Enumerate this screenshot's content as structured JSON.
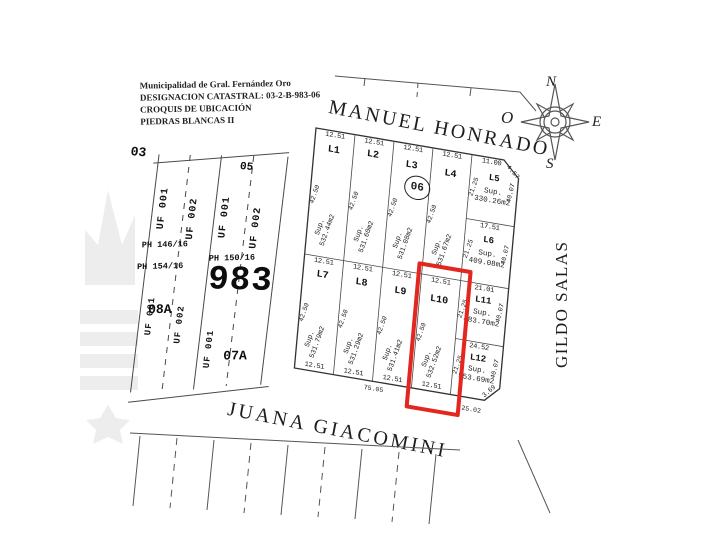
{
  "header": {
    "line1": "Municipalidad de Gral. Fernández Oro",
    "line2": "DESIGNACION CATASTRAL: 03-2-B-983-06",
    "line3": "CROQUIS DE UBICACIÓN",
    "line4": "PIEDRAS BLANCAS II"
  },
  "streets": {
    "top": "MANUEL HONRADO",
    "bottom": "JUANA GIACOMINI",
    "right": "GILDO SALAS"
  },
  "compass": {
    "n": "N",
    "e": "E",
    "s": "S",
    "w": "O"
  },
  "badge": "06",
  "left_block": {
    "corner": "03",
    "strip_a": {
      "uf1": "UF 001",
      "uf2": "UF 002",
      "ph1": "PH 146/16",
      "ph2": "PH 154/16",
      "uf3": "UF 001",
      "uf4": "UF 002",
      "label": "08A"
    },
    "strip_b": {
      "top": "05",
      "uf1": "UF 001",
      "uf2": "UF 002",
      "ph1": "PH 150/16",
      "big": "983",
      "uf3": "UF 001",
      "label": "07A"
    }
  },
  "lots": [
    {
      "id": "L1",
      "front": "12.51",
      "side": "42.50",
      "sup": "Sup.",
      "area": "532.44m2"
    },
    {
      "id": "L2",
      "front": "12.51",
      "side": "42.50",
      "sup": "Sup.",
      "area": "531.60m2"
    },
    {
      "id": "L3",
      "front": "12.51",
      "side": "42.50",
      "sup": "Sup.",
      "area": "531.08m2"
    },
    {
      "id": "L4",
      "front": "12.51",
      "side": "42.50",
      "sup": "Sup.",
      "area": "531.67m2"
    },
    {
      "id": "L5",
      "front": "11.00",
      "chamfer": "4.57",
      "left": "21.25",
      "right": "40.07",
      "sup": "Sup.",
      "area": "330.26m2"
    },
    {
      "id": "L6",
      "front": "17.51",
      "left": "21.25",
      "right": "40.07",
      "sup": "Sup.",
      "area": "409.08m2"
    },
    {
      "id": "L7",
      "front": "12.51",
      "bottom": "12.51",
      "side": "42.50",
      "sup": "Sup.",
      "area": "531.79m2"
    },
    {
      "id": "L8",
      "front": "12.51",
      "bottom": "12.51",
      "side": "42.50",
      "sup": "Sup.",
      "area": "531.29m2"
    },
    {
      "id": "L9",
      "front": "12.51",
      "bottom": "12.51",
      "side": "42.50",
      "sup": "Sup.",
      "area": "531.41m2"
    },
    {
      "id": "L10",
      "front": "12.51",
      "bottom": "12.51",
      "side": "42.50",
      "sup": "Sup.",
      "area": "532.52m2",
      "highlighted": true
    },
    {
      "id": "L11",
      "front": "21.01",
      "left": "21.25",
      "right": "40.07",
      "sup": "Sup.",
      "area": "483.70m2"
    },
    {
      "id": "L12",
      "front": "24.52",
      "left": "21.25",
      "right": "40.07",
      "sup": "Sup.",
      "area": "553.69m2"
    }
  ],
  "measurements": {
    "bottom_left": "75.05",
    "bottom_right": "25.02",
    "se_chamfer": "3.69"
  },
  "colors": {
    "highlight": "#e3261f",
    "line": "#4a4a4a",
    "watermark": "#ededed"
  }
}
